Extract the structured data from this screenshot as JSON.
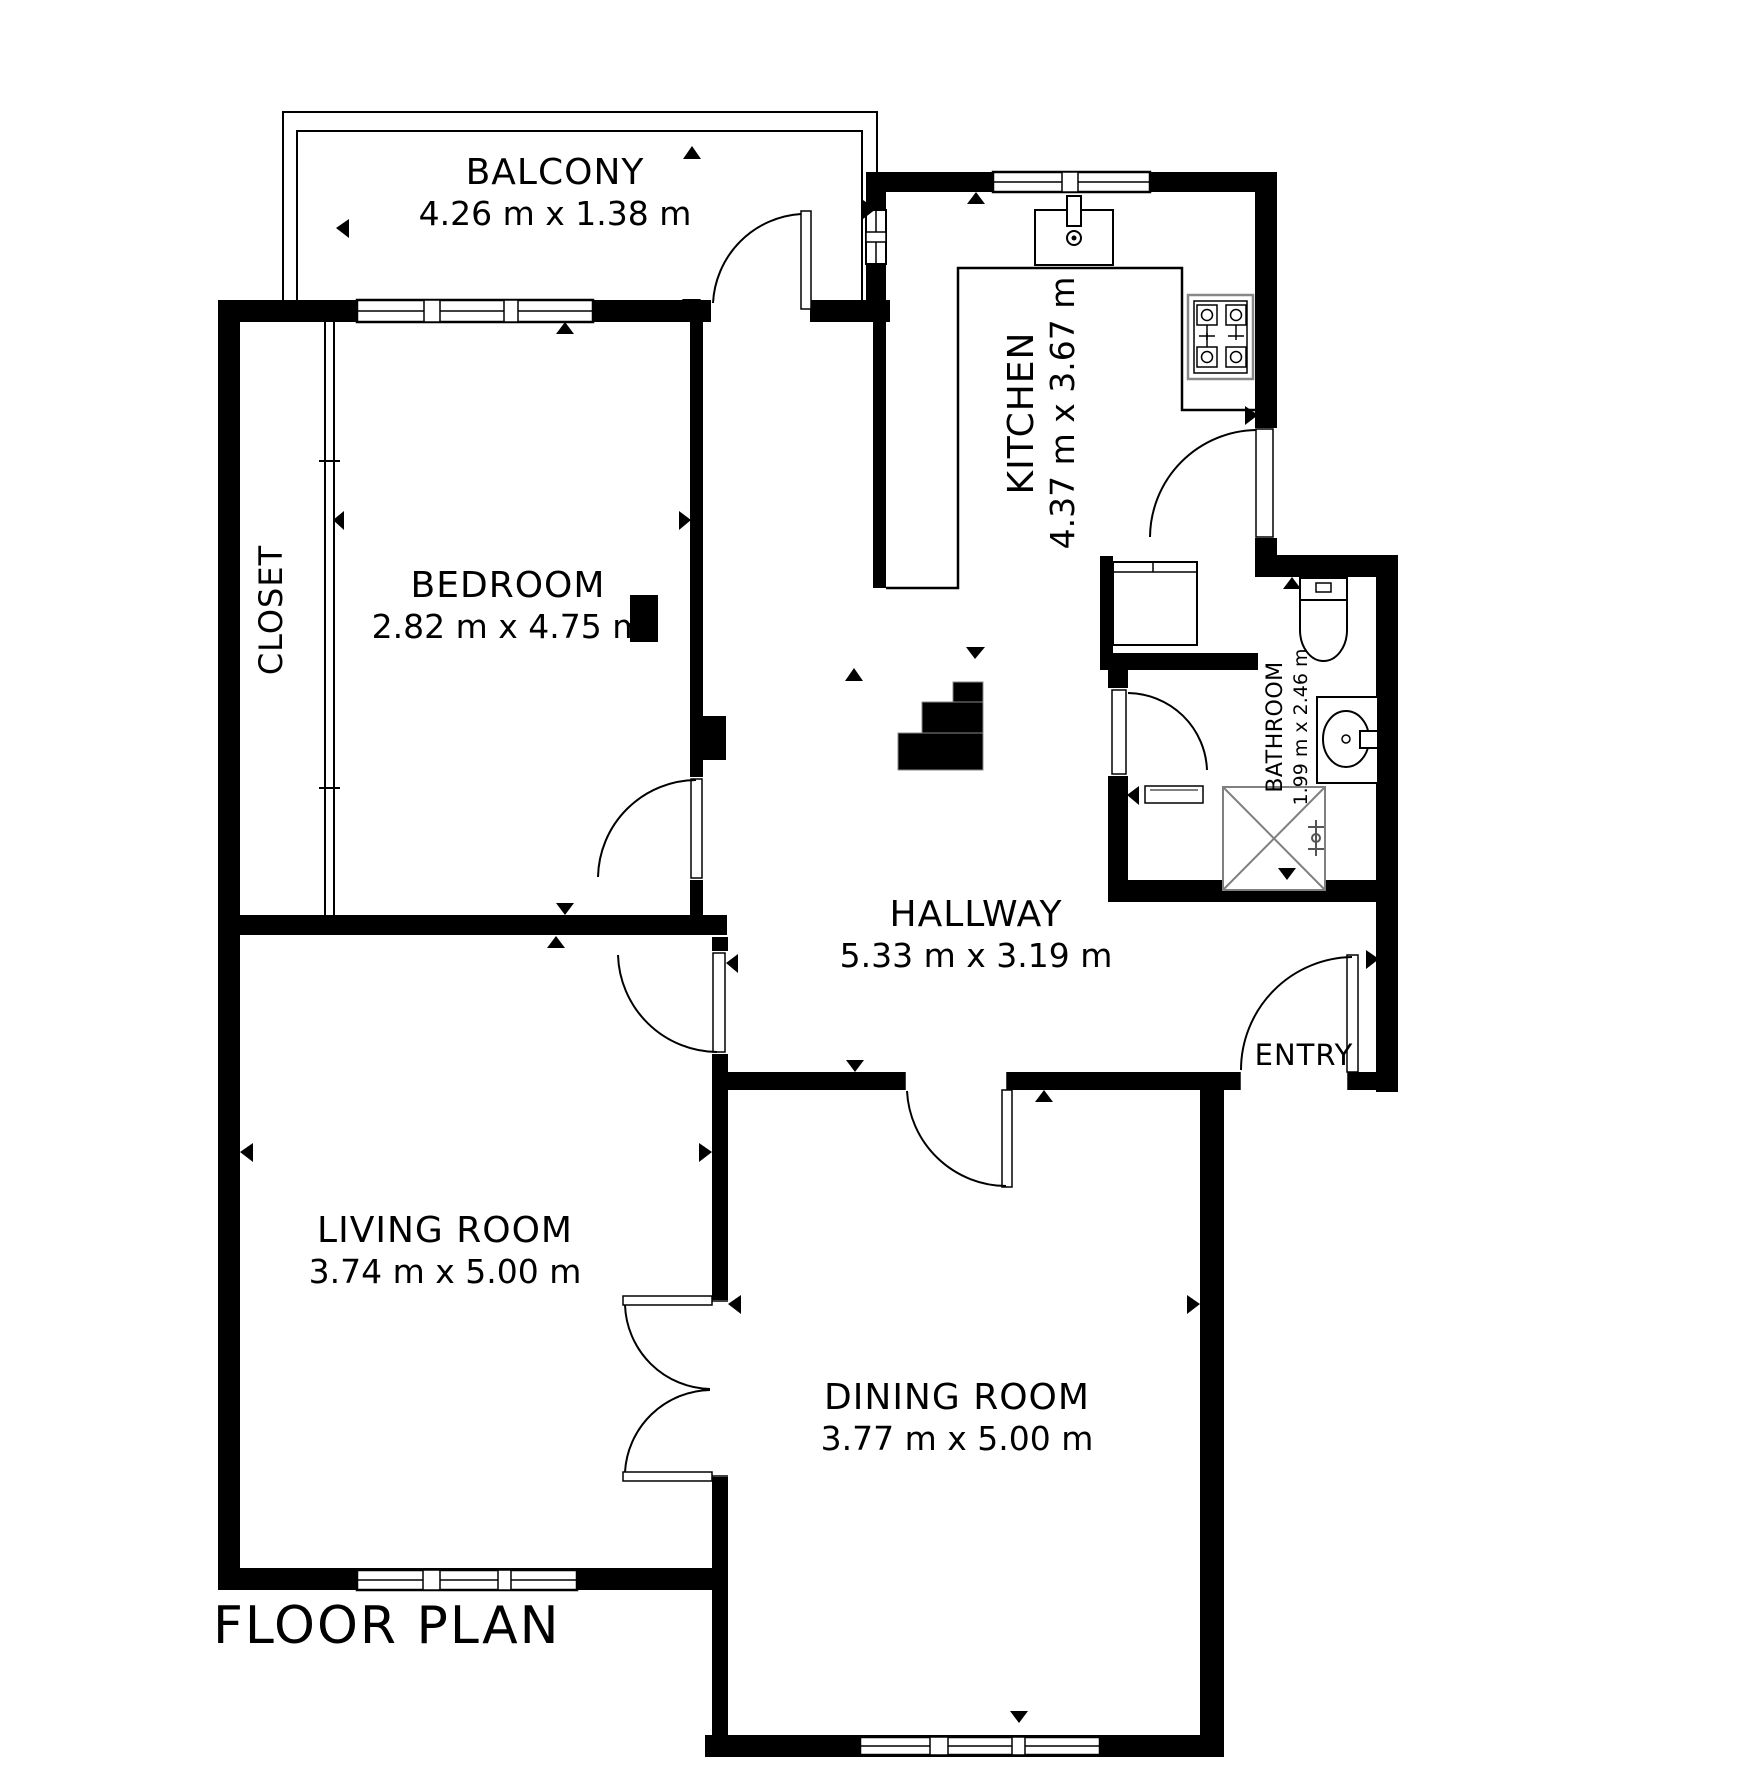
{
  "title": "FLOOR PLAN",
  "colors": {
    "wall": "#000000",
    "background": "#ffffff",
    "fixture_gray": "#808080"
  },
  "rooms": {
    "balcony": {
      "name": "BALCONY",
      "dims": "4.26 m x 1.38 m"
    },
    "kitchen": {
      "name": "KITCHEN",
      "dims": "4.37 m x 3.67 m"
    },
    "closet": {
      "name": "CLOSET"
    },
    "bedroom": {
      "name": "BEDROOM",
      "dims": "2.82 m x 4.75 m"
    },
    "bathroom": {
      "name": "BATHROOM",
      "dims": "1.99 m x 2.46 m"
    },
    "hallway": {
      "name": "HALLWAY",
      "dims": "5.33 m x 3.19 m"
    },
    "living_room": {
      "name": "LIVING ROOM",
      "dims": "3.74 m x 5.00 m"
    },
    "dining_room": {
      "name": "DINING ROOM",
      "dims": "3.77 m x 5.00 m"
    },
    "entry": {
      "name": "ENTRY"
    }
  }
}
